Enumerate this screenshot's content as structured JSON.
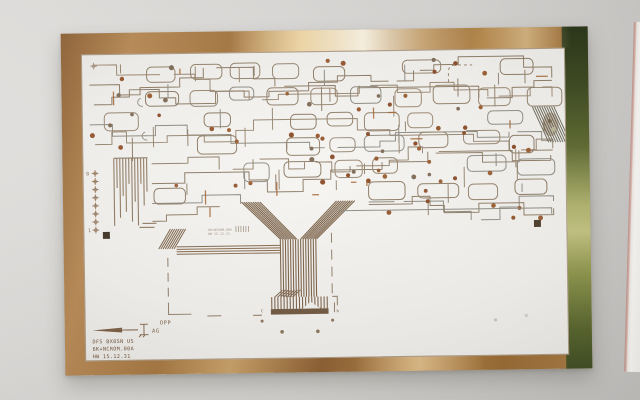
{
  "board": {
    "legend": {
      "direction_label": "AG",
      "line1": "DFS BX0SN US",
      "line2": "6K+NCROM.00A",
      "line3": "HW 15.12.31"
    },
    "fold_mark_label": "OPP",
    "stamp": {
      "line1": "6K+NCROM.00A",
      "line2": "HW 15.12.31"
    },
    "registration": {
      "top_label": "8",
      "bottom_label": "1"
    },
    "connector_marks": {
      "left": "C",
      "right": "7",
      "far_right": "b"
    }
  },
  "colors": {
    "copper_frame": "#b8895a",
    "copper_highlight": "#f3ddb0",
    "copper_dark": "#7c5327",
    "oxide_green": "#5c682e",
    "substrate_white": "#f2f1ee",
    "trace_brown": "#93816a",
    "trace_gray": "#8d8b80",
    "pad_rust": "#8a4b26",
    "rust_accent": "#a2602e",
    "wall_gray": "#d9d8d6"
  }
}
